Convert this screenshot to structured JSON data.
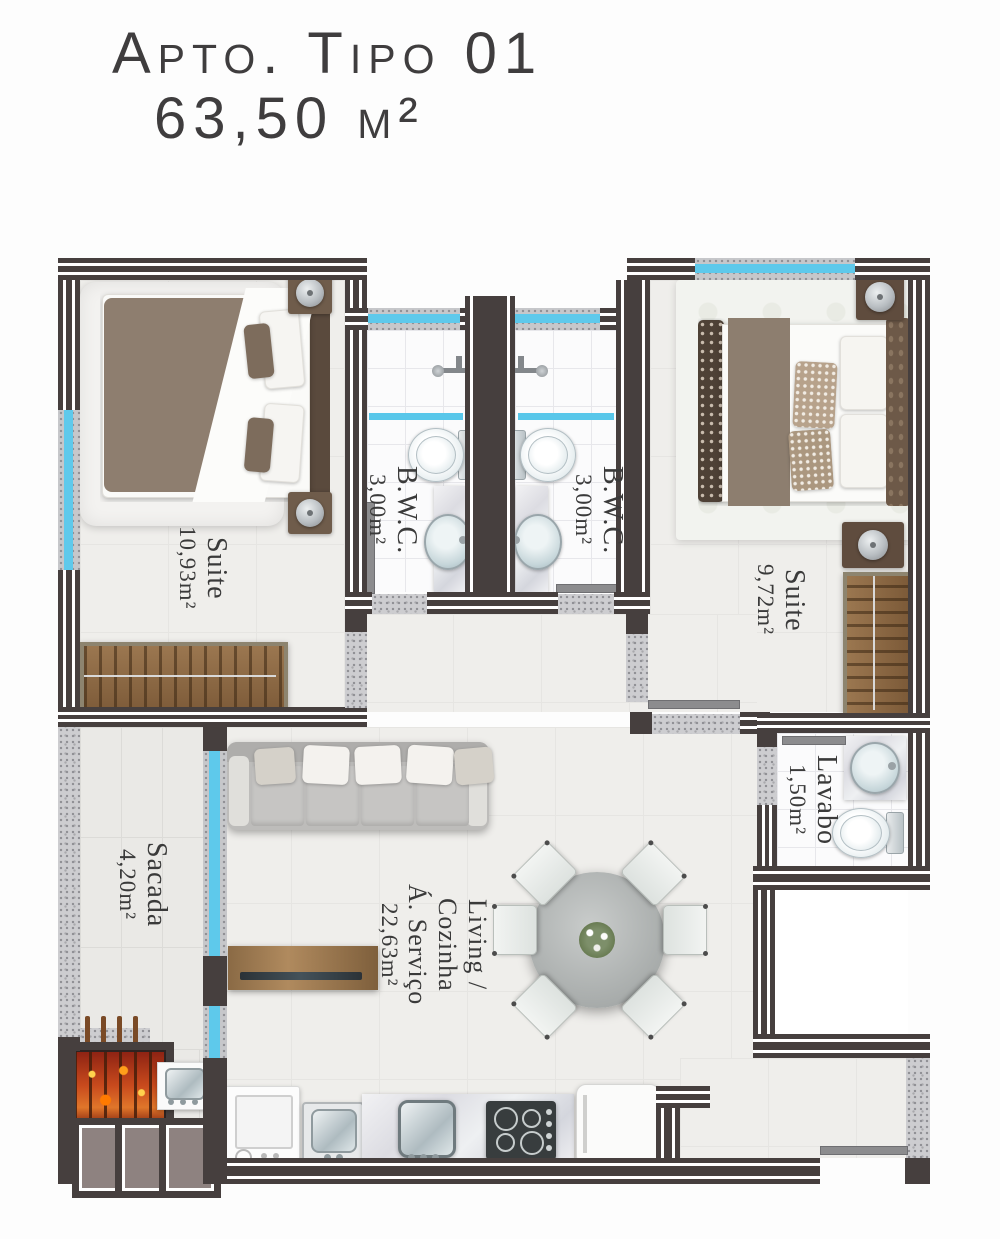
{
  "title": {
    "line1": "Apto. Tipo 01",
    "line2": "63,50 m²"
  },
  "rooms": {
    "suite1": {
      "name": "Suite",
      "area": "10,93m²"
    },
    "bwc1": {
      "name": "B.W.C.",
      "area": "3,00m²"
    },
    "bwc2": {
      "name": "B.W.C.",
      "area": "3,00m²"
    },
    "suite2": {
      "name": "Suite",
      "area": "9,72m²"
    },
    "lavabo": {
      "name": "Lavabo",
      "area": "1,50m²"
    },
    "sacada": {
      "name": "Sacada",
      "area": "4,20m²"
    },
    "living": {
      "name_line1": "Living / Cozinha",
      "name_line2": "Á. Serviço",
      "area": "22,63m²"
    }
  },
  "furniture_items": [
    "double-bed",
    "nightstand",
    "table-lamp",
    "wardrobe",
    "rug",
    "shower",
    "shower-glass",
    "toilet",
    "washbasin",
    "vanity-counter",
    "sofa",
    "throw-pillow",
    "tv-rack",
    "round-dining-table",
    "dining-chair",
    "flower-centerpiece",
    "washing-machine",
    "laundry-tank",
    "kitchen-sink",
    "cooktop",
    "refrigerator",
    "barbecue-grill",
    "entry-door",
    "glass-door"
  ],
  "colors": {
    "wall": "#463f3e",
    "wall_stripe": "#ffffff",
    "window_glass": "#5ec9eb",
    "floor": "#efeeeb",
    "bath_tile": "#fbfbfc",
    "threshold_granite": "#cdcdd0",
    "wood": "#8a6947",
    "duvet_brown": "#8e7e6f",
    "pillar_fill": "#8e8280",
    "fire": "#c84a1d",
    "text": "#3a3a3a"
  }
}
